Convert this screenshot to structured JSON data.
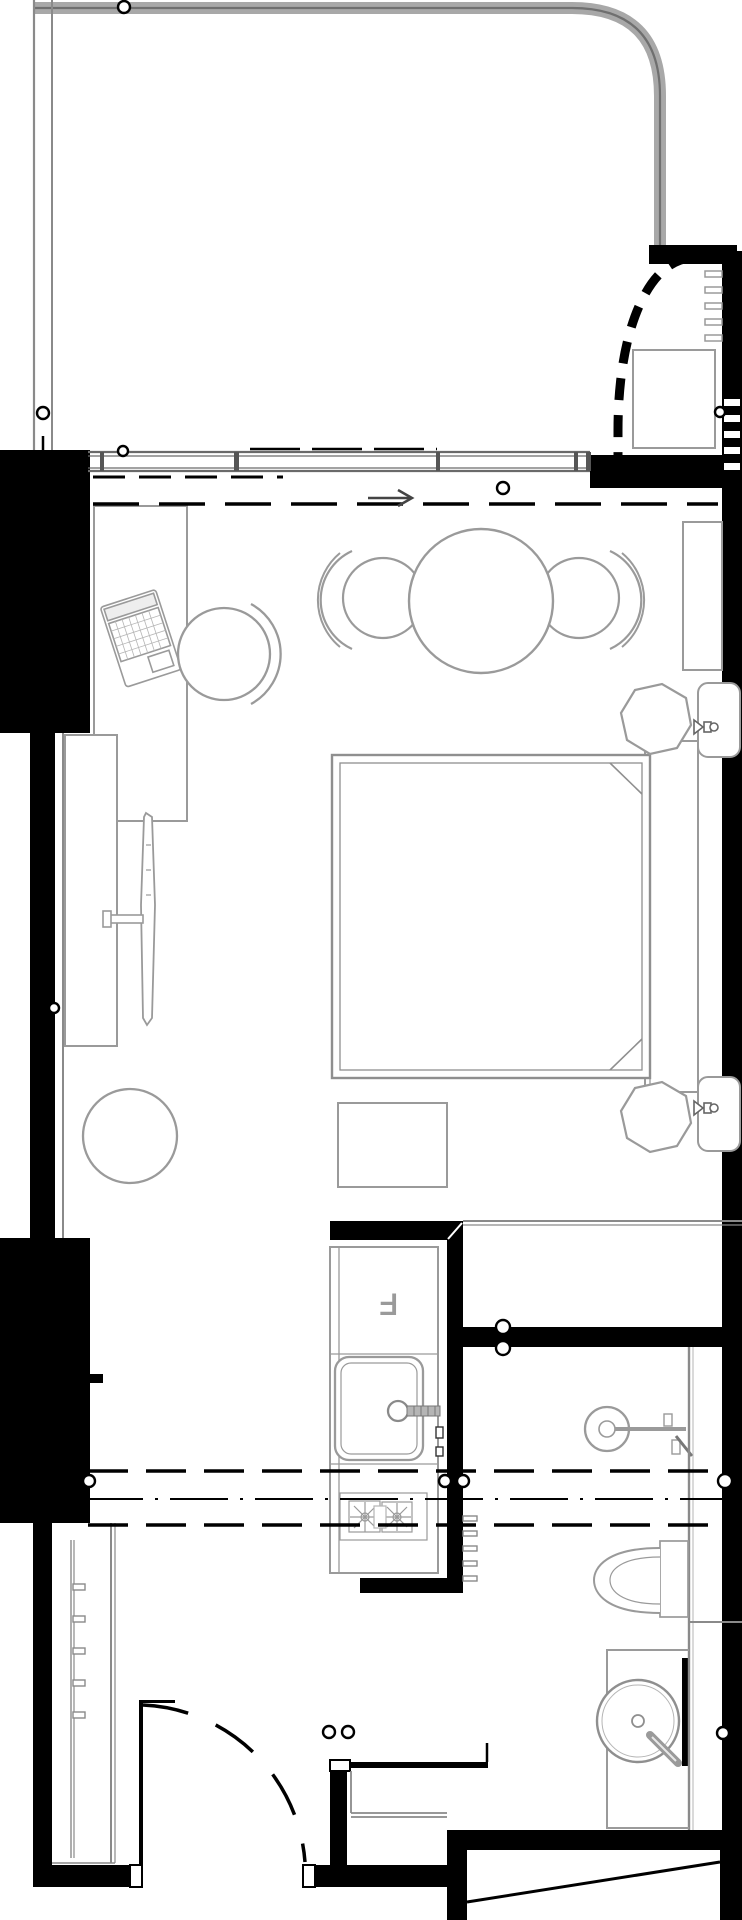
{
  "meta": {
    "title": "Hotel guestroom floor plan",
    "drawing_type": "architectural plan, no text annotations except one appliance label"
  },
  "labels": {
    "fridge": "F"
  },
  "colors": {
    "background": "#ffffff",
    "wall_poche": "#000000",
    "furniture_line": "#9a9a9a",
    "glazing_line": "#8a8a8a",
    "annotation": "#000000"
  },
  "rooms": [
    {
      "name": "balcony-terrace",
      "position": "top, curved gray parapet"
    },
    {
      "name": "curved-closet",
      "position": "top-right, dashed curved partition"
    },
    {
      "name": "bedroom-living",
      "position": "middle"
    },
    {
      "name": "kitchenette",
      "position": "center-bottom column"
    },
    {
      "name": "bathroom-wet-zone",
      "position": "bottom-right"
    },
    {
      "name": "entry-hall",
      "position": "bottom-left"
    }
  ],
  "fixtures": [
    "desk",
    "laptop",
    "desk-chair",
    "lounge-chair-left",
    "lounge-chair-right",
    "round-dining-table",
    "tv-media-console",
    "wall-tv-panel",
    "tv-cabinet",
    "double-bed",
    "headboard",
    "nightstand-top",
    "nightstand-bottom",
    "wall-sconce-top",
    "wall-sconce-bottom",
    "bench-ottoman",
    "round-pouf",
    "kitchen-counter",
    "fridge",
    "kitchen-sink",
    "kitchen-faucet",
    "decorative-hob",
    "shower-mixer",
    "toilet",
    "vanity-counter",
    "vessel-sink",
    "vanity-faucet",
    "glass-partition",
    "entry-door",
    "door-swing-arc",
    "wardrobe-coat-rack",
    "entry-bench",
    "closet-cabinet",
    "shelf-hooks"
  ],
  "annotations": {
    "slide_arrow_direction": "right",
    "dashed_track_lines_top": 2,
    "dashed_section_lines_bottom": 3,
    "circle_markers": 14
  }
}
